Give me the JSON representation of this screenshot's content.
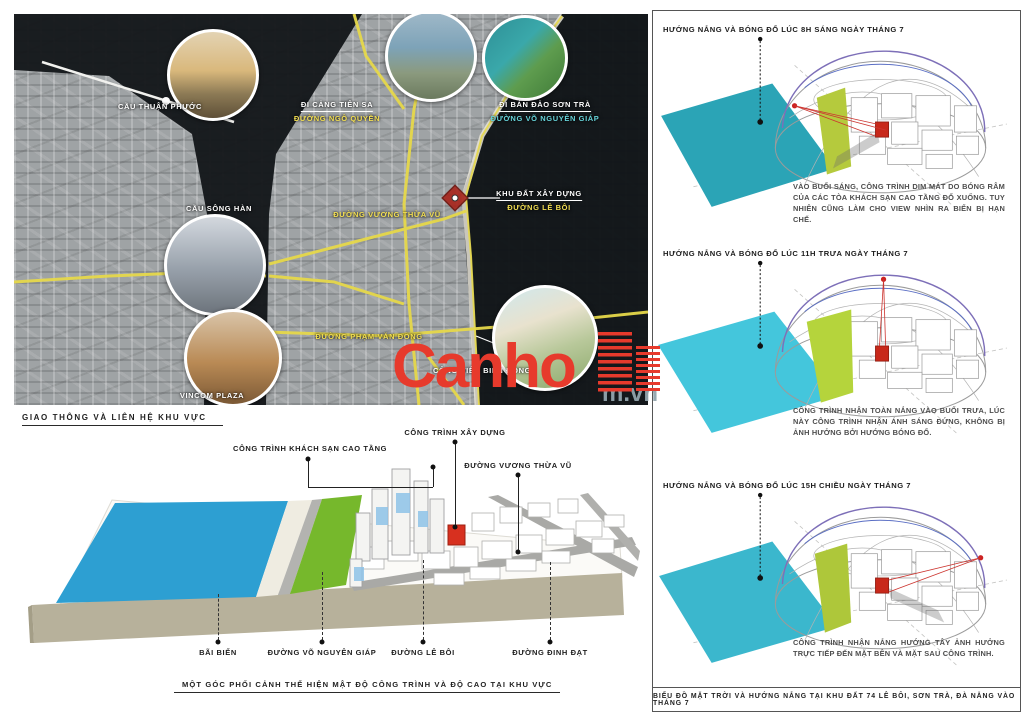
{
  "map": {
    "caption": "GIAO THÔNG VÀ LIÊN HỆ KHU VỰC",
    "labels": {
      "cau_thuan_phuoc": "CẦU THUẬN PHƯỚC",
      "cau_song_han": "CẦU SÔNG HÀN",
      "vincom_plaza": "VINCOM PLAZA",
      "di_cang_tien_sa": "ĐI CẢNG TIÊN SA",
      "duong_ngo_quyen": "ĐƯỜNG NGÔ QUYỀN",
      "di_ban_dao_son_tra": "ĐI BÁN ĐẢO SƠN TRÀ",
      "duong_vo_nguyen_giap": "ĐƯỜNG VÕ NGUYÊN GIÁP",
      "khu_dat_xay_dung": "KHU ĐẤT XÂY DỰNG",
      "duong_le_boi": "ĐƯỜNG LÊ BÔI",
      "duong_vuong_thua_vu": "ĐƯỜNG VƯƠNG THỪA VŨ",
      "duong_pham_van_dong": "ĐƯỜNG PHẠM VĂN ĐỒNG",
      "cong_vien_bien_dong": "CÔNG VIÊN BIỂN ĐÔNG"
    }
  },
  "watermark": {
    "text": "Canho",
    "suffix": "m.vn",
    "color": "#e73a2c"
  },
  "perspective": {
    "caption": "MỘT GÓC PHỐI CẢNH THỂ HIỆN MẬT ĐỘ CÔNG TRÌNH VÀ ĐỘ CAO TẠI KHU VỰC",
    "labels_top": [
      "CÔNG TRÌNH KHÁCH SẠN CAO TẦNG",
      "CÔNG TRÌNH XÂY DỰNG",
      "ĐƯỜNG VƯƠNG THỪA VŨ"
    ],
    "labels_bottom": [
      "BÃI BIỂN",
      "ĐƯỜNG VÕ NGUYÊN GIÁP",
      "ĐƯỜNG LÊ BÔI",
      "ĐƯỜNG ĐINH ĐẠT"
    ]
  },
  "sun": {
    "caption": "BIỂU ĐỒ MẶT TRỜI VÀ HƯỚNG NẮNG TẠI KHU ĐẤT 74 LÊ BÔI, SƠN TRÀ, ĐÀ NẴNG VÀO THÁNG 7",
    "sections": [
      {
        "title": "HƯỚNG NẮNG VÀ BÓNG ĐỔ LÚC 8H SÁNG NGÀY THÁNG 7",
        "desc": "VÀO BUỔI SÁNG, CÔNG TRÌNH DIM MÁT DO BÓNG RÂM CỦA CÁC TÒA KHÁCH SẠN CAO TẦNG ĐỔ XUỐNG. TUY NHIÊN CŨNG LÀM CHO VIEW NHÌN RA BIỂN BỊ HẠN CHẾ."
      },
      {
        "title": "HƯỚNG NẮNG VÀ BÓNG ĐỔ LÚC 11H TRƯA NGÀY THÁNG 7",
        "desc": "CÔNG TRÌNH NHẬN TOÀN NẮNG VÀO BUỔI TRƯA, LÚC NÀY CÔNG TRÌNH NHẬN ÁNH SÁNG ĐỨNG, KHÔNG BỊ ẢNH HƯỞNG BỞI HƯỚNG BÓNG ĐỔ."
      },
      {
        "title": "HƯỚNG NẮNG VÀ BÓNG ĐỔ LÚC 15H CHIỀU NGÀY THÁNG 7",
        "desc": "CÔNG TRÌNH NHẬN NẮNG HƯỚNG TÂY ẢNH HƯỞNG TRỰC TIẾP ĐẾN MẶT BÊN VÀ MẶT SAU CÔNG TRÌNH."
      }
    ]
  },
  "colors": {
    "sea_3d": "#2d9fd2",
    "green_strip": "#76b82c",
    "site_red": "#c8281a",
    "teal_plane_1": "#2ba4b6",
    "teal_plane_2": "#44c6dc",
    "teal_plane_3": "#3bb7cd",
    "road_yellow": "#e6d84a",
    "watermark_red": "#e73a2c"
  }
}
